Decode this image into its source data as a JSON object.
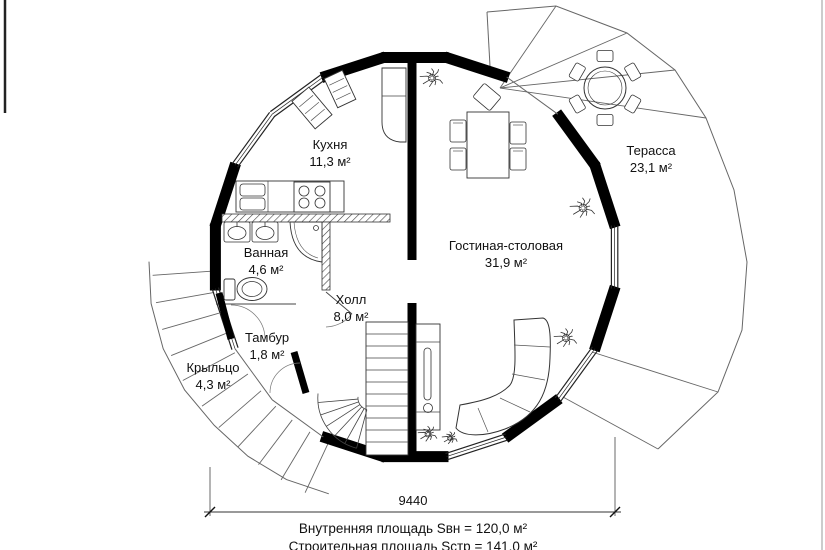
{
  "rooms": [
    {
      "id": "kitchen",
      "name": "Кухня",
      "area": "11,3 м²"
    },
    {
      "id": "terrace",
      "name": "Терасса",
      "area": "23,1 м²"
    },
    {
      "id": "bathroom",
      "name": "Ванная",
      "area": "4,6 м²"
    },
    {
      "id": "living",
      "name": "Гостиная-столовая",
      "area": "31,9 м²"
    },
    {
      "id": "hall",
      "name": "Холл",
      "area": "8,0 м²"
    },
    {
      "id": "vestibule",
      "name": "Тамбур",
      "area": "1,8 м²"
    },
    {
      "id": "porch",
      "name": "Крыльцо",
      "area": "4,3 м²"
    }
  ],
  "dimension": {
    "value": "9440"
  },
  "summary": {
    "internal_area": "Внутренняя площадь Sвн = 120,0 м²",
    "construction_area": "Строительная площадь Sстр = 141,0 м²"
  },
  "colors": {
    "wall": "#000000",
    "thin_line": "#555555",
    "background": "#ffffff",
    "text": "#111111"
  }
}
